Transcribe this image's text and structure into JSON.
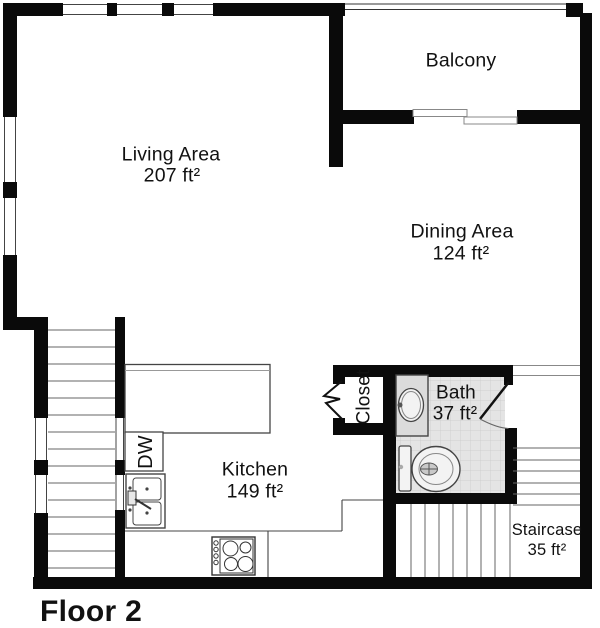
{
  "title": "Floor 2",
  "rooms": {
    "living": {
      "name": "Living Area",
      "area": "207 ft²"
    },
    "dining": {
      "name": "Dining Area",
      "area": "124 ft²"
    },
    "balcony": {
      "name": "Balcony"
    },
    "kitchen": {
      "name": "Kitchen",
      "area": "149 ft²"
    },
    "bath": {
      "name": "Bath",
      "area": "37 ft²"
    },
    "closet": {
      "name": "Closet"
    },
    "staircase": {
      "name": "Staircase",
      "area": "35 ft²"
    }
  },
  "appliances": {
    "dishwasher": "DW"
  },
  "colors": {
    "background": "#ffffff",
    "wall": "#0a0a0a",
    "line": "#444444",
    "stairline": "#666666",
    "tile": "#e4e4e4",
    "tile_grid": "#cfcfcf",
    "text": "#111111"
  }
}
